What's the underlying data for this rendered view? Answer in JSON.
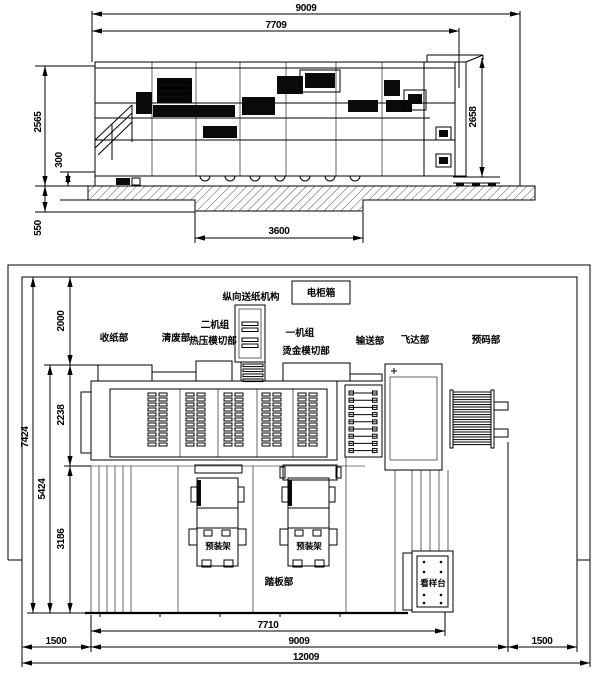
{
  "drawing": {
    "elevation": {
      "total_width": "9009",
      "inner_width": "7709",
      "height_left": "2565",
      "base_height": "300",
      "pit_depth": "550",
      "pit_width": "3600",
      "height_right": "2658"
    },
    "plan": {
      "rear_clearance": "2000",
      "body_depth": "2238",
      "front_depth": "3186",
      "sub_depth": "5424",
      "total_depth": "7424",
      "machine_length": "7710",
      "span_length": "9009",
      "left_clearance": "1500",
      "right_clearance": "1500",
      "total_length": "12009",
      "labels": {
        "feed_mechanism": "纵向送纸机构",
        "cabinet": "电柜箱",
        "delivery": "收纸部",
        "stripping": "清废部",
        "unit2_line1": "二机组",
        "unit2_line2": "热压模切部",
        "unit1_line1": "一机组",
        "unit1_line2": "烫金模切部",
        "conveyor": "输送部",
        "feeder": "飞达部",
        "prestack": "预码部",
        "prerack": "预装架",
        "footboard": "踏板部",
        "sample_table": "看样台"
      }
    }
  }
}
